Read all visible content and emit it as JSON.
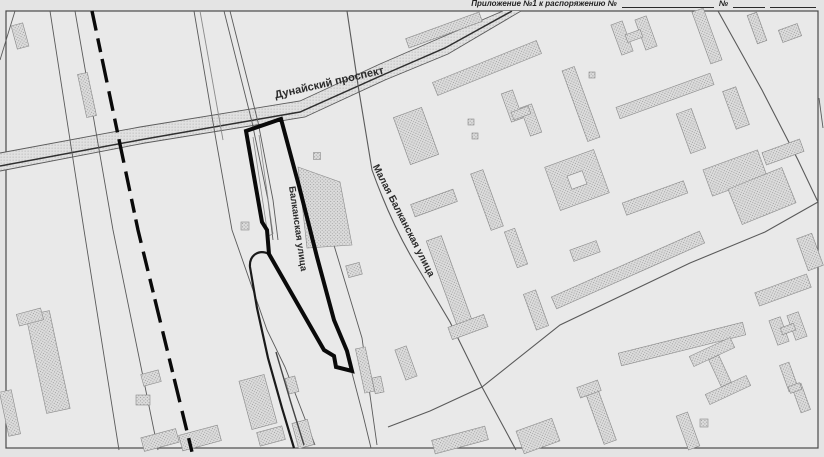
{
  "caption": {
    "appendix_text": "Приложение №1 к распоряжению №",
    "number_sign": "№"
  },
  "map": {
    "street_labels": {
      "dunaysky": "Дунайский проспект",
      "malaya_balkanskaya": "Малая Балканская улица",
      "balkanskaya": "Балканская улица"
    },
    "features": {
      "parcel_boundary": "bold black outlined land plot along Balkanskaya ulitsa",
      "dashed_line": "bold dashed boundary line on the west side",
      "road_band": "stippled band of Dunaysky prospekt"
    },
    "colors": {
      "paper": "#e9e9e9",
      "boundary": "#0a0a0a",
      "road_line": "#5a5a5a",
      "building_fill": "#dcdcdc",
      "building_dot": "#8f8f8f",
      "frame": "#444444"
    }
  }
}
